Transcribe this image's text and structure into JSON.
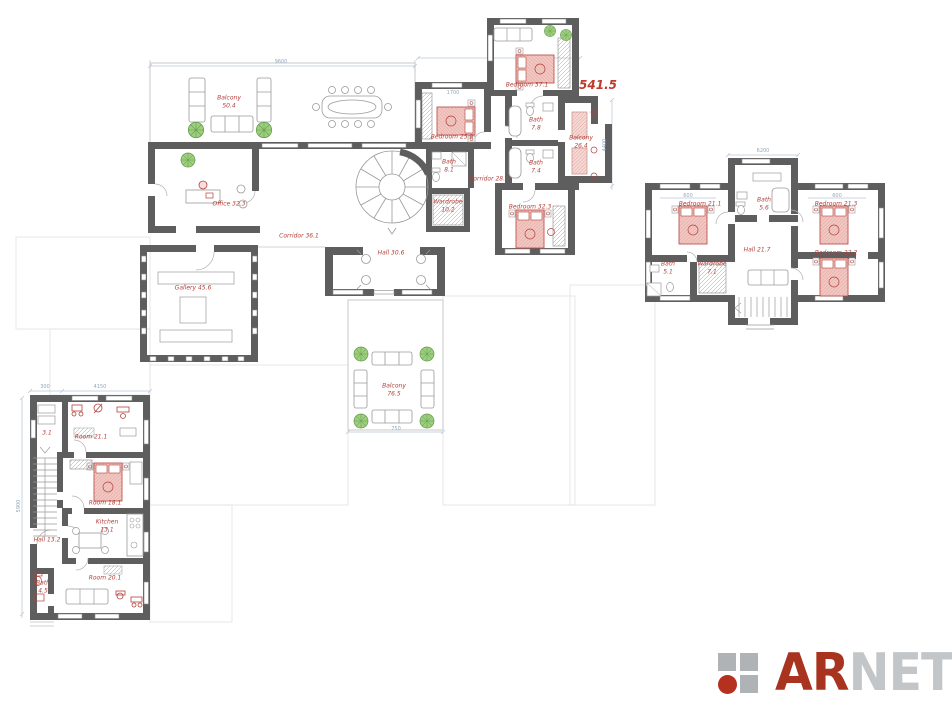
{
  "plan": {
    "total_area": "541.5",
    "rooms": [
      {
        "name": "Balcony",
        "area": "50.4"
      },
      {
        "name": "Office 32.3"
      },
      {
        "name": "Gallery 45.6"
      },
      {
        "name": "Corridor 36.1"
      },
      {
        "name": "Hall 30.6"
      },
      {
        "name": "Bath",
        "area": "8.1"
      },
      {
        "name": "Wardrobe",
        "area": "10.2"
      },
      {
        "name": "Bedroom 25.8"
      },
      {
        "name": "Bedroom 37.1"
      },
      {
        "name": "Bath",
        "area": "7.8"
      },
      {
        "name": "Bath",
        "area": "7.4"
      },
      {
        "name": "Corridor 28.4"
      },
      {
        "name": "Bedroom 32.3"
      },
      {
        "name": "Balcony",
        "area": "26.4"
      },
      {
        "name": "Bedroom 21.1"
      },
      {
        "name": "Bath",
        "area": "5.6"
      },
      {
        "name": "Bedroom 21.3"
      },
      {
        "name": "Bedroom 22.2"
      },
      {
        "name": "Hall 21.7"
      },
      {
        "name": "Wardrobe",
        "area": "7.1"
      },
      {
        "name": "Bath",
        "area": "5.1"
      },
      {
        "name": "Room 21.1"
      },
      {
        "name": "Room 18.1"
      },
      {
        "name": "Kitchen",
        "area": "13.1"
      },
      {
        "name": "Hall 13.2"
      },
      {
        "name": "Bath",
        "area": "4.5"
      },
      {
        "name": "Room 20.1"
      },
      {
        "name": "3.1"
      },
      {
        "name": "Balcony",
        "area": "76.5"
      }
    ],
    "dimensions": [
      "9600",
      "1700",
      "600",
      "600",
      "4400",
      "750",
      "5900",
      "6200",
      "4150",
      "300"
    ]
  },
  "logo": {
    "text_primary": "AR",
    "text_secondary": "NET"
  },
  "colors": {
    "wall": "#5e5e5e",
    "room_label": "#b5403a",
    "dimension": "#8fa8bd",
    "furniture_accent": "#b5403a",
    "bed_fill": "#f2c7c2",
    "plant_green": "#9ccf7d",
    "logo_red": "#b5301f",
    "logo_gray": "#b0b3b5"
  }
}
